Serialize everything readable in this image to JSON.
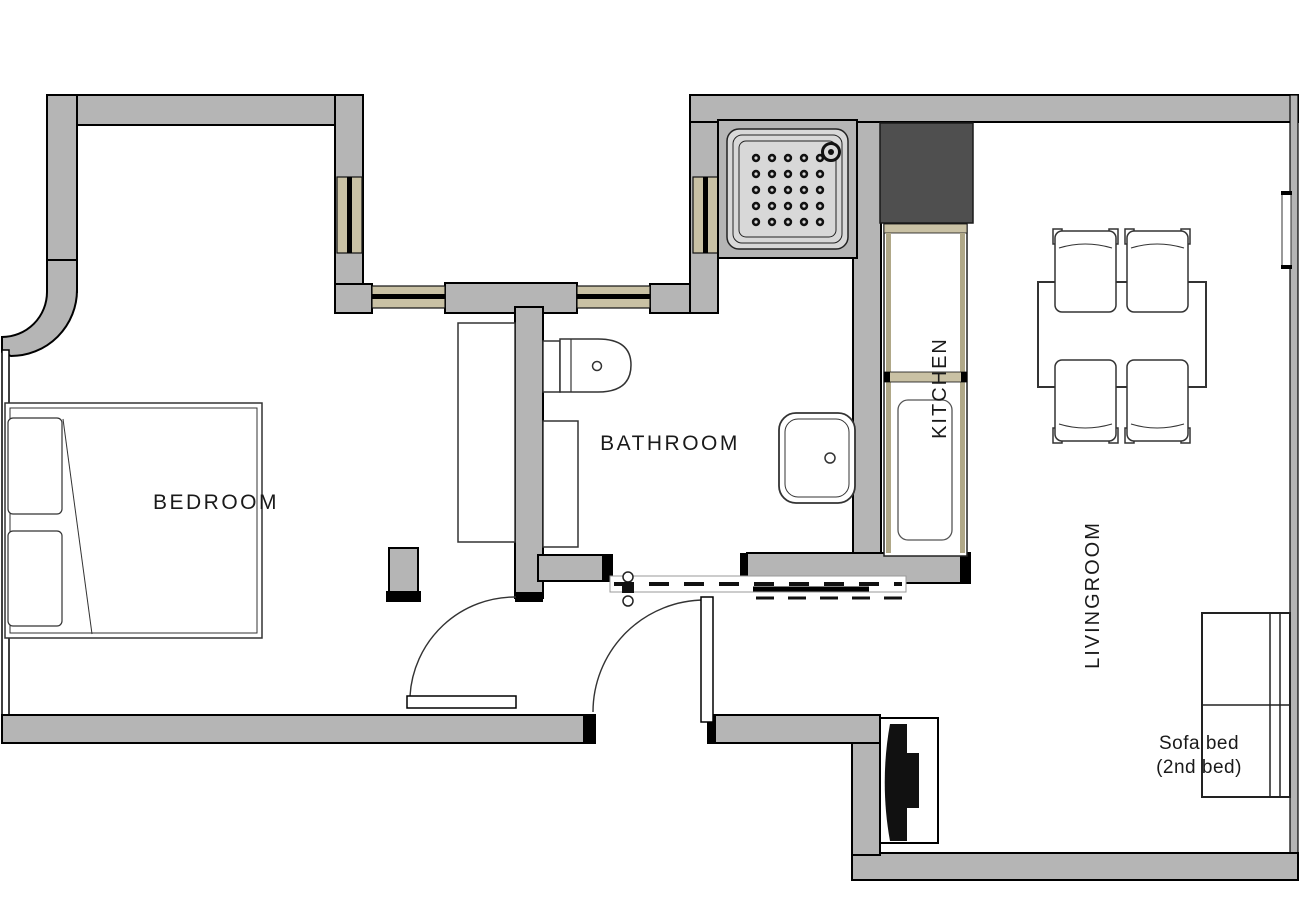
{
  "rooms": {
    "bedroom": "BEDROOM",
    "bathroom": "BATHROOM",
    "kitchen": "KITCHEN",
    "livingroom": "LIVINGROOM"
  },
  "annotations": {
    "sofa_line1": "Sofa bed",
    "sofa_line2": "(2nd bed)"
  },
  "colors": {
    "background": "#ffffff",
    "wall": "#b5b5b5",
    "outline": "#000000",
    "window_frame": "#c9c1a4",
    "counter_edge": "#b0a888",
    "dark_unit": "#4f4f4f",
    "shower_tray": "#d8d8d8",
    "label_text": "#1a1a1a"
  }
}
